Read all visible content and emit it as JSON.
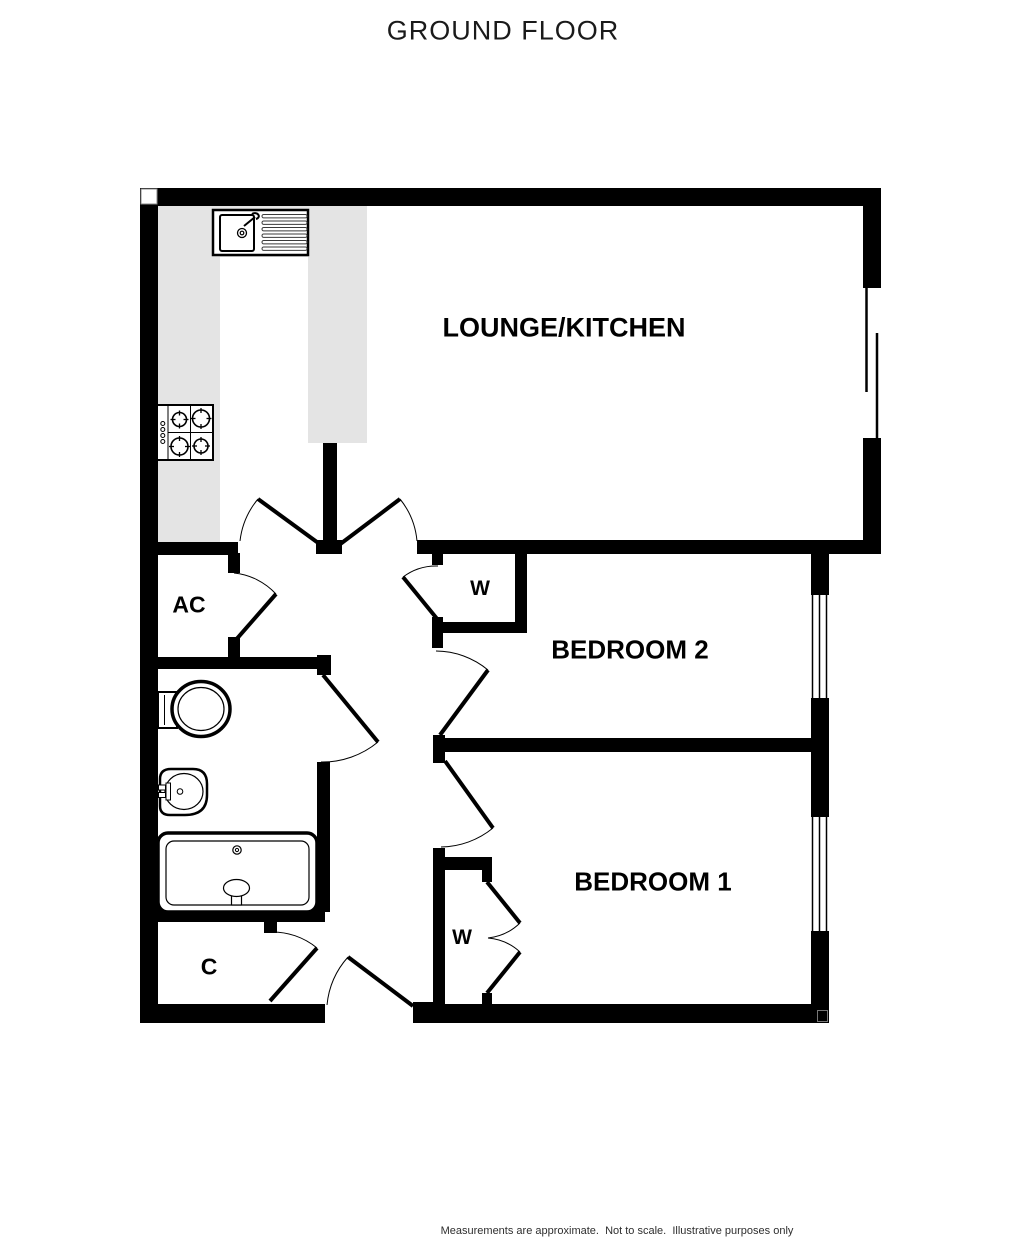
{
  "title": "GROUND FLOOR",
  "floorplan": {
    "rooms": {
      "lounge_kitchen": {
        "label": "LOUNGE/KITCHEN"
      },
      "bedroom2": {
        "label": "BEDROOM 2"
      },
      "bedroom1": {
        "label": "BEDROOM 1"
      },
      "ac": {
        "label": "AC"
      },
      "wardrobe_bedroom2": {
        "label": "W"
      },
      "wardrobe_bedroom1": {
        "label": "W"
      },
      "cupboard": {
        "label": "C"
      }
    },
    "colors": {
      "wall": "#000000",
      "counter": "#e4e4e4",
      "background": "#ffffff"
    }
  },
  "footer": {
    "line1": "Measurements are approximate.  Not to scale.  Illustrative purposes only",
    "line2": "Made with Metropix ©2024"
  }
}
